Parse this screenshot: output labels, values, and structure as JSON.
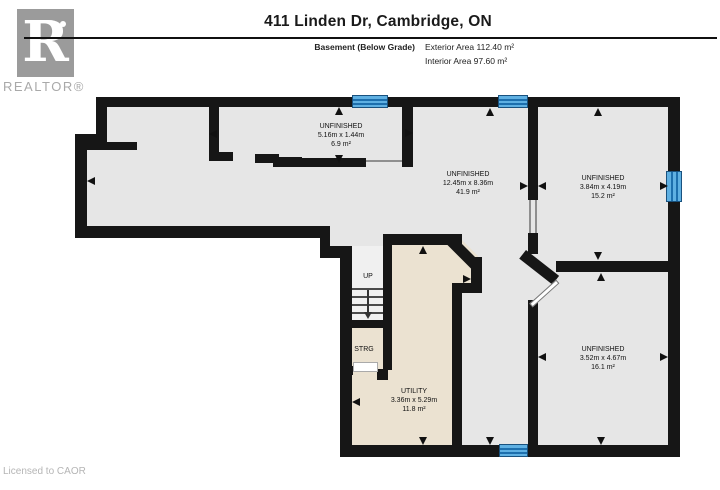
{
  "header": {
    "title": "411 Linden Dr, Cambridge, ON",
    "floor_label": "Basement (Below Grade)",
    "exterior_area": "Exterior Area 112.40 m²",
    "interior_area": "Interior Area 97.60 m²"
  },
  "logo": {
    "letter": "R",
    "wordmark": "REALTOR®"
  },
  "footer": {
    "license": "Licensed to CAOR"
  },
  "rooms": [
    {
      "id": "unfinished-top",
      "name": "UNFINISHED",
      "dims": "5.16m x 1.44m",
      "area": "6.9 m²"
    },
    {
      "id": "unfinished-main",
      "name": "UNFINISHED",
      "dims": "12.45m x 8.36m",
      "area": "41.9 m²"
    },
    {
      "id": "unfinished-top-right",
      "name": "UNFINISHED",
      "dims": "3.84m x 4.19m",
      "area": "15.2 m²"
    },
    {
      "id": "unfinished-bottom-right",
      "name": "UNFINISHED",
      "dims": "3.52m x 4.67m",
      "area": "16.1 m²"
    },
    {
      "id": "utility",
      "name": "UTILITY",
      "dims": "3.36m x 5.29m",
      "area": "11.8 m²"
    }
  ],
  "stairs": {
    "up": "UP",
    "storage": "STRG"
  },
  "colors": {
    "wall": "#161616",
    "floor": "#e6e6e6",
    "utility_floor": "#ebe2d1",
    "window_blue": "#5fb0e2",
    "window_pane_line": "#1d6fad",
    "logo_grey": "#9b9b9b"
  }
}
